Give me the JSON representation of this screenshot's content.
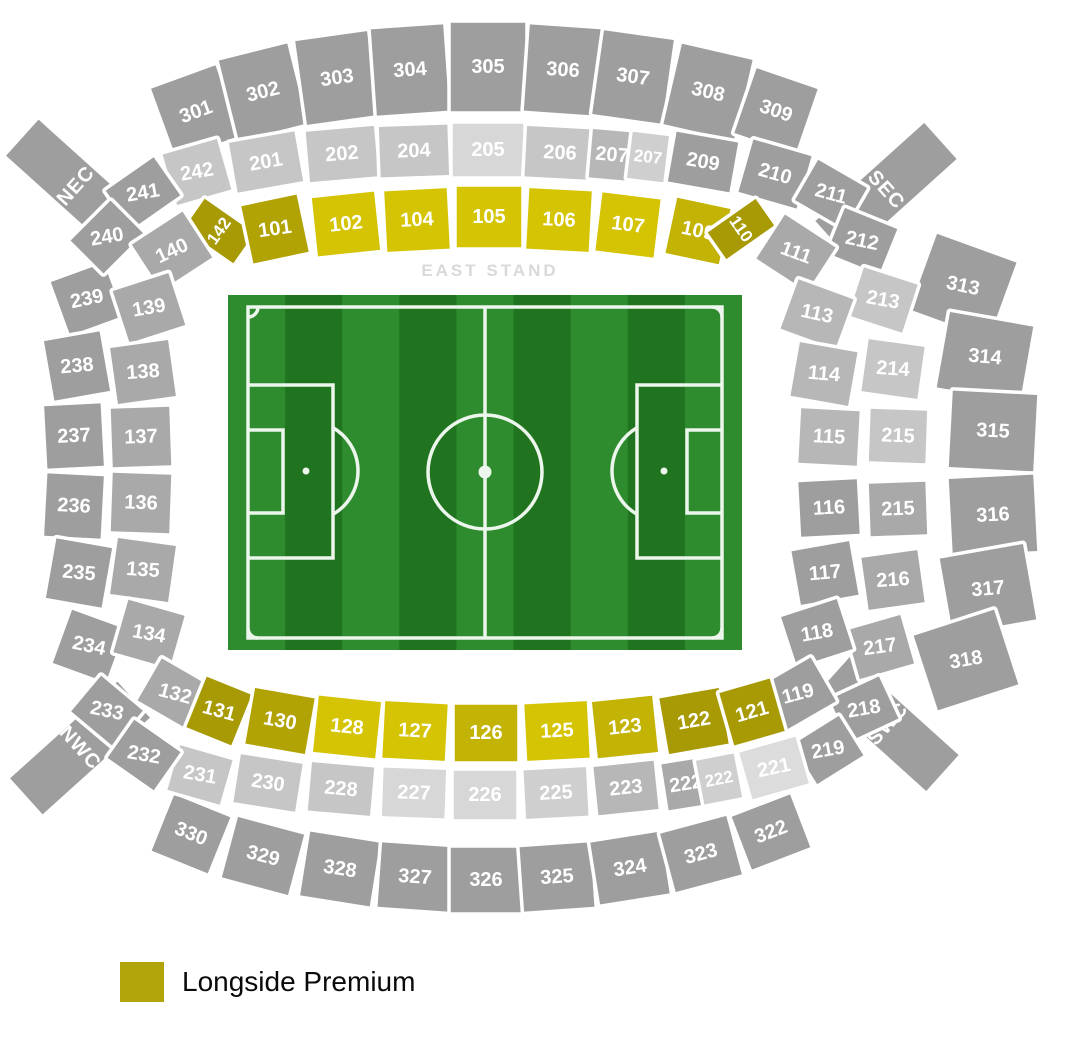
{
  "stand_label": "EAST STAND",
  "legend": {
    "swatch_color": "#b1a40b",
    "label": "Longside Premium"
  },
  "stadium": {
    "palette": {
      "g1": "#9e9e9e",
      "g2": "#a9a9a9",
      "g3": "#b7b7b7",
      "g4": "#c6c6c6",
      "g5": "#cfcfcf",
      "g6": "#d7d7d7",
      "g7": "#dcdcdc",
      "y1": "#d4c403",
      "y2": "#c2b305",
      "y3": "#b1a304",
      "y4": "#a79a04"
    },
    "section_fields": [
      "label",
      "x",
      "y",
      "w",
      "h",
      "rot",
      "fill",
      "label_rot",
      "is_corner_stand"
    ],
    "sections": [
      [
        "NEC",
        76,
        186,
        52,
        148,
        -48,
        "g1",
        null,
        1
      ],
      [
        "SEC",
        886,
        190,
        52,
        150,
        48,
        "g1",
        null,
        1
      ],
      [
        "NWC",
        80,
        748,
        52,
        148,
        48,
        "g1",
        null,
        1
      ],
      [
        "SWC",
        888,
        724,
        52,
        150,
        -48,
        "g1",
        null,
        1
      ],
      [
        "301",
        196,
        112,
        72,
        78,
        -20,
        "g1"
      ],
      [
        "302",
        263,
        92,
        74,
        86,
        -14,
        "g1"
      ],
      [
        "303",
        337,
        78,
        76,
        88,
        -8,
        "g1"
      ],
      [
        "304",
        410,
        70,
        76,
        90,
        -4,
        "g1"
      ],
      [
        "305",
        488,
        67,
        78,
        92,
        0,
        "g1"
      ],
      [
        "306",
        563,
        70,
        76,
        90,
        4,
        "g1"
      ],
      [
        "307",
        633,
        77,
        74,
        88,
        8,
        "g1"
      ],
      [
        "308",
        708,
        92,
        76,
        86,
        13,
        "g1"
      ],
      [
        "309",
        776,
        111,
        68,
        72,
        19,
        "g1"
      ],
      [
        "242",
        197,
        172,
        60,
        56,
        -16,
        "g4",
        -10
      ],
      [
        "201",
        266,
        162,
        70,
        54,
        -10,
        "g4"
      ],
      [
        "202",
        342,
        154,
        72,
        54,
        -5,
        "g4"
      ],
      [
        "204",
        414,
        151,
        72,
        54,
        -2,
        "g4"
      ],
      [
        "205",
        488,
        150,
        74,
        56,
        0,
        "g6"
      ],
      [
        "206",
        560,
        153,
        72,
        54,
        3,
        "g4"
      ],
      [
        "207",
        612,
        155,
        46,
        52,
        5,
        "g3"
      ],
      [
        "207",
        648,
        157,
        40,
        50,
        7,
        "g5"
      ],
      [
        "209",
        703,
        162,
        66,
        54,
        10,
        "g1"
      ],
      [
        "210",
        775,
        174,
        64,
        58,
        16,
        "g1"
      ],
      [
        "142",
        219,
        231,
        40,
        64,
        -55,
        "y4"
      ],
      [
        "101",
        275,
        229,
        60,
        62,
        -12,
        "y3",
        -8
      ],
      [
        "102",
        346,
        224,
        66,
        62,
        -6,
        "y1"
      ],
      [
        "104",
        417,
        220,
        66,
        64,
        -3,
        "y1"
      ],
      [
        "105",
        489,
        217,
        68,
        64,
        0,
        "y1"
      ],
      [
        "106",
        559,
        220,
        66,
        64,
        3,
        "y1"
      ],
      [
        "107",
        628,
        225,
        62,
        62,
        7,
        "y1"
      ],
      [
        "109",
        698,
        231,
        58,
        60,
        12,
        "y2"
      ],
      [
        "110",
        741,
        229,
        36,
        62,
        55,
        "y4"
      ],
      [
        "239",
        87,
        299,
        60,
        60,
        -20,
        "g1",
        -12
      ],
      [
        "238",
        77,
        366,
        60,
        64,
        -10,
        "g1",
        -5
      ],
      [
        "237",
        74,
        436,
        60,
        66,
        -3,
        "g1"
      ],
      [
        "236",
        74,
        506,
        60,
        66,
        3,
        "g1"
      ],
      [
        "235",
        79,
        573,
        60,
        64,
        10,
        "g1",
        5
      ],
      [
        "234",
        89,
        646,
        60,
        60,
        20,
        "g1",
        12
      ],
      [
        "241",
        143,
        193,
        62,
        50,
        -35,
        "g1",
        -10
      ],
      [
        "240",
        107,
        237,
        60,
        50,
        -45,
        "g1",
        -10
      ],
      [
        "140",
        172,
        251,
        64,
        58,
        -33,
        "g2",
        -25
      ],
      [
        "139",
        149,
        308,
        62,
        58,
        -18,
        "g2",
        -10
      ],
      [
        "138",
        143,
        372,
        62,
        60,
        -8,
        "g2",
        -4
      ],
      [
        "137",
        141,
        437,
        62,
        62,
        -2,
        "g2"
      ],
      [
        "136",
        141,
        503,
        62,
        62,
        2,
        "g2"
      ],
      [
        "135",
        143,
        570,
        62,
        60,
        8,
        "g2",
        4
      ],
      [
        "134",
        149,
        634,
        62,
        58,
        16,
        "g2",
        10
      ],
      [
        "313",
        963,
        286,
        88,
        84,
        20,
        "g1",
        12
      ],
      [
        "314",
        985,
        357,
        88,
        80,
        10,
        "g1",
        5
      ],
      [
        "315",
        993,
        431,
        88,
        80,
        3,
        "g1"
      ],
      [
        "316",
        993,
        515,
        88,
        80,
        -3,
        "g1"
      ],
      [
        "317",
        988,
        589,
        88,
        80,
        -10,
        "g1",
        -5
      ],
      [
        "318",
        966,
        660,
        88,
        82,
        -18,
        "g1",
        -10
      ],
      [
        "211",
        831,
        194,
        60,
        50,
        30,
        "g1",
        15
      ],
      [
        "212",
        862,
        241,
        60,
        52,
        22,
        "g1",
        12
      ],
      [
        "213",
        883,
        300,
        60,
        54,
        18,
        "g4",
        10
      ],
      [
        "214",
        893,
        369,
        60,
        56,
        8,
        "g4",
        4
      ],
      [
        "215",
        898,
        436,
        60,
        56,
        2,
        "g4"
      ],
      [
        "215",
        898,
        509,
        60,
        56,
        -2,
        "g2"
      ],
      [
        "216",
        893,
        580,
        60,
        56,
        -8,
        "g2",
        -4
      ],
      [
        "217",
        880,
        647,
        60,
        54,
        -16,
        "g2",
        -8
      ],
      [
        "218",
        864,
        709,
        58,
        50,
        -25,
        "g1",
        -10
      ],
      [
        "219",
        828,
        750,
        58,
        50,
        -32,
        "g1",
        -10
      ],
      [
        "111",
        796,
        253,
        64,
        56,
        33,
        "g2",
        20
      ],
      [
        "113",
        817,
        314,
        62,
        56,
        20,
        "g3",
        12
      ],
      [
        "114",
        824,
        374,
        62,
        58,
        10,
        "g3",
        5
      ],
      [
        "115",
        829,
        437,
        62,
        58,
        3,
        "g3"
      ],
      [
        "116",
        829,
        508,
        62,
        58,
        -3,
        "g1"
      ],
      [
        "117",
        825,
        573,
        62,
        58,
        -10,
        "g1",
        -5
      ],
      [
        "118",
        817,
        633,
        62,
        56,
        -18,
        "g1",
        -10
      ],
      [
        "119",
        798,
        694,
        62,
        54,
        -30,
        "g1",
        -15
      ],
      [
        "330",
        191,
        834,
        64,
        64,
        22,
        "g1"
      ],
      [
        "329",
        263,
        856,
        72,
        66,
        15,
        "g1"
      ],
      [
        "328",
        340,
        869,
        74,
        68,
        9,
        "g1"
      ],
      [
        "327",
        415,
        877,
        74,
        68,
        4,
        "g1"
      ],
      [
        "326",
        486,
        880,
        74,
        68,
        0,
        "g1"
      ],
      [
        "325",
        557,
        877,
        74,
        68,
        -4,
        "g1"
      ],
      [
        "324",
        630,
        868,
        74,
        66,
        -9,
        "g1"
      ],
      [
        "323",
        701,
        854,
        72,
        64,
        -15,
        "g1"
      ],
      [
        "322",
        771,
        832,
        66,
        60,
        -21,
        "g1"
      ],
      [
        "231",
        200,
        775,
        58,
        50,
        16,
        "g4",
        10
      ],
      [
        "230",
        268,
        783,
        66,
        52,
        9,
        "g4"
      ],
      [
        "228",
        341,
        789,
        66,
        52,
        5,
        "g4"
      ],
      [
        "227",
        414,
        793,
        66,
        52,
        2,
        "g6"
      ],
      [
        "226",
        485,
        795,
        66,
        52,
        0,
        "g6"
      ],
      [
        "225",
        556,
        793,
        66,
        52,
        -3,
        "g5"
      ],
      [
        "223",
        626,
        788,
        64,
        52,
        -6,
        "g3"
      ],
      [
        "222",
        686,
        784,
        46,
        50,
        -9,
        "g2"
      ],
      [
        "222",
        719,
        779,
        42,
        48,
        -11,
        "g5"
      ],
      [
        "221",
        774,
        768,
        62,
        52,
        -16,
        "g7",
        -12
      ],
      [
        "233",
        107,
        711,
        58,
        50,
        40,
        "g1",
        12
      ],
      [
        "232",
        144,
        755,
        60,
        50,
        35,
        "g1",
        10
      ],
      [
        "132",
        175,
        694,
        62,
        52,
        30,
        "g2",
        15
      ],
      [
        "131",
        219,
        711,
        52,
        58,
        22,
        "y4",
        15
      ],
      [
        "130",
        280,
        721,
        64,
        60,
        10,
        "y3"
      ],
      [
        "128",
        347,
        727,
        66,
        60,
        6,
        "y1"
      ],
      [
        "127",
        415,
        731,
        66,
        60,
        3,
        "y1"
      ],
      [
        "126",
        486,
        733,
        66,
        60,
        0,
        "y2"
      ],
      [
        "125",
        557,
        731,
        66,
        60,
        -3,
        "y1"
      ],
      [
        "123",
        625,
        727,
        64,
        60,
        -6,
        "y2"
      ],
      [
        "122",
        694,
        721,
        64,
        60,
        -10,
        "y4"
      ],
      [
        "121",
        752,
        712,
        56,
        58,
        -16,
        "y4"
      ]
    ],
    "pitch": {
      "x": 228,
      "y": 295,
      "w": 514,
      "h": 355,
      "stripes": 9,
      "stripe_colors": [
        "#2e8b2e",
        "#20741f"
      ],
      "line_color": "#ecf6ec"
    }
  }
}
